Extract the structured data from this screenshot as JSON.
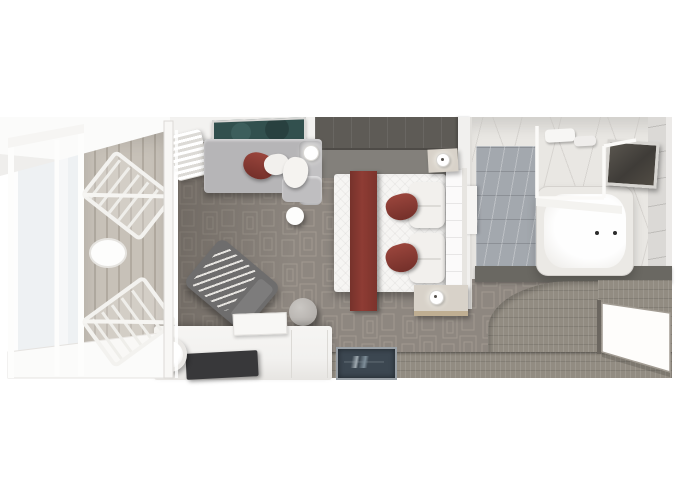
{
  "page": {
    "background": "#ffffff",
    "description": "Top-down 3D architectural rendering of a suite stateroom floor plan with balcony, living area, bedroom, bathroom and entry"
  },
  "palette": {
    "bg": "#ffffff",
    "wall-white": "#f3f2f0",
    "deck-wood": "#c7c1b8",
    "deck-wood-dark": "#b1aaa0",
    "glass-pale": "#eef1f3",
    "frame-white": "#f8f7f5",
    "carpet": "#8e8780",
    "carpet-line": "#b0a99f",
    "wallpaper": "#83807b",
    "wallpaper-line": "#a09d98",
    "wardrobe-dark": "#5e5b56",
    "concrete": "#a09a92",
    "sofa-gray": "#b6b5b7",
    "pillow-white": "#f2f0ed",
    "accent-maroon": "#8e3c34",
    "accent-maroon-dark": "#74302a",
    "art-teal": "#32504e",
    "chair-dark": "#6e6d6d",
    "chair-stripe": "#e6e4e0",
    "ottoman-gray": "#b5b1ad",
    "desk-white": "#f2f1ef",
    "tv-dark": "#38383a",
    "bed-white": "#f6f5f3",
    "headboard-white": "#fbfafa",
    "nightstand-tan": "#d8d2c9",
    "nightstand-wood": "#bfae92",
    "marble-white": "#e9e7e3",
    "marble-vein": "#c6c3bf",
    "marble-blue": "#a3a8ae",
    "tub-white": "#fefefe",
    "tub-rim": "#ebe9e5",
    "dark-wall": "#6a6862",
    "mirror-dark": "#3f3c38",
    "entry-wood": "#928c82",
    "mat-navy": "#3c4751",
    "mat-border": "#9aa1a7",
    "door-white": "#fefdfb",
    "door-edge": "#a29c93"
  },
  "scene": {
    "view": "top-down-3d-render",
    "rooms": [
      {
        "name": "balcony",
        "floor": "wood-deck-planks",
        "furniture": [
          "glass-railing",
          "lounge-chair",
          "lounge-chair",
          "round-deck-table",
          "sliding-glass-door"
        ]
      },
      {
        "name": "living-area",
        "floor": "patterned-gray-carpet",
        "furniture": [
          "sofa-daybed",
          "red-accent-pillow",
          "white-throw-pillows",
          "framed-wall-art",
          "wall-sconce",
          "sheer-curtain",
          "round-side-table",
          "striped-accent-armchair",
          "round-ottoman",
          "desk-console",
          "table-lamp",
          "tv-panel",
          "vanity-tray"
        ]
      },
      {
        "name": "bedroom",
        "floor": "patterned-gray-carpet",
        "furniture": [
          "king-bed",
          "maroon-bed-runner",
          "maroon-accent-pillow",
          "maroon-accent-pillow",
          "white-pillow-stack",
          "white-pillow-stack",
          "quilted-headboard",
          "nightstand",
          "nightstand",
          "bedside-lamp",
          "bedside-lamp",
          "wardrobe-band",
          "textured-wallpaper"
        ]
      },
      {
        "name": "bathroom",
        "floor": "white-marble",
        "furniture": [
          "bathtub",
          "tub-fixtures",
          "glass-shower-enclosure",
          "blue-marble-shower-floor",
          "framed-vanity-mirror",
          "towel-shelf",
          "bathroom-door"
        ]
      },
      {
        "name": "entry",
        "floor": "gray-wood-planks",
        "furniture": [
          "entrance-door",
          "navy-doormat"
        ]
      }
    ]
  }
}
